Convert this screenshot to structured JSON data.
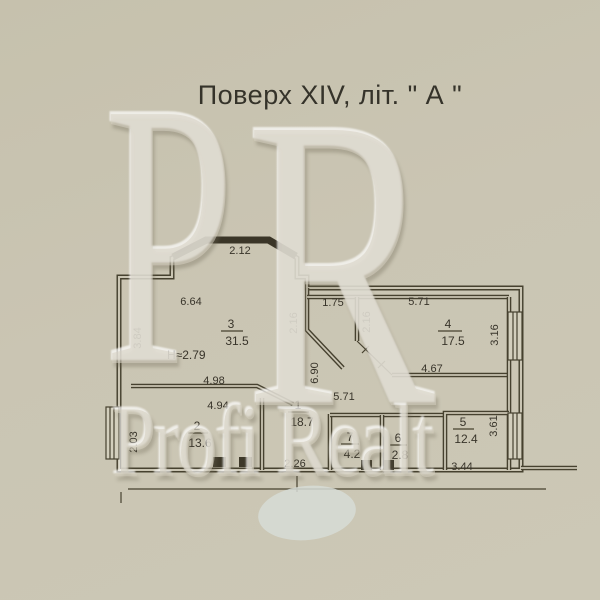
{
  "title": "Поверх XIV, літ. \" А \"",
  "watermark": {
    "letter_first": "P",
    "letter_second": "R",
    "brand": "Profi Realt"
  },
  "note_ceiling_height": "Н≈2.79",
  "rooms": [
    {
      "number": "1",
      "area": "18.7"
    },
    {
      "number": "2",
      "area": "13.6"
    },
    {
      "number": "3",
      "area": "31.5"
    },
    {
      "number": "4",
      "area": "17.5"
    },
    {
      "number": "5",
      "area": "12.4"
    },
    {
      "number": "6",
      "area": "2.8"
    },
    {
      "number": "7",
      "area": "4.2"
    }
  ],
  "dimensions": {
    "bay_width": "2.12",
    "room3_top": "6.64",
    "room3_left": "3.84",
    "room3_bottom": "4.98",
    "room2_top": "4.94",
    "room2_left": "2.03",
    "niche_width": "1.75",
    "niche_left": "2.16",
    "room4_side": "2.16",
    "room4_top": "5.71",
    "room4_right": "3.16",
    "room4_bottom": "4.67",
    "hall_depth": "6.90",
    "hall_width": "5.71",
    "entry_width": "2.26",
    "room5_right": "3.61",
    "room5_bottom": "3.44"
  },
  "colors": {
    "paper": "#c9c4b1",
    "ink": "#46412f",
    "watermark": "#d8d3c2",
    "stamp_blob": "#d7dcd6"
  }
}
